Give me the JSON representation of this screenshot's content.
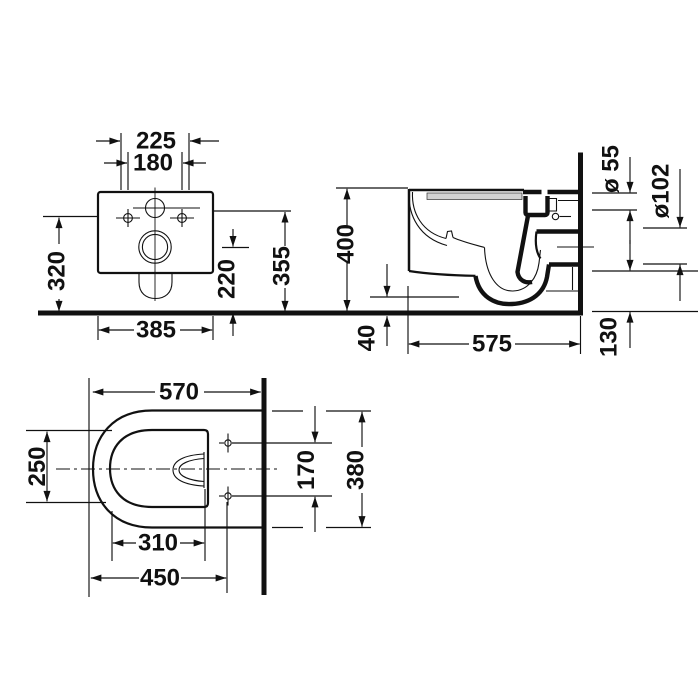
{
  "drawing": {
    "type": "technical-orthographic-drawing",
    "subject": "wall-hung toilet",
    "colors": {
      "line": "#111111",
      "seat_band": "#d2d2d2",
      "background": "#ffffff"
    },
    "views": {
      "rear": {
        "name": "rear view",
        "dims": {
          "supply_span": "225",
          "hole_span": "180",
          "height_left": "320",
          "height_right": "355",
          "outlet_height": "220",
          "width": "385"
        }
      },
      "side": {
        "name": "side section view",
        "dims": {
          "height": "400",
          "floor_gap": "40",
          "depth": "575",
          "outlet_drop": "130",
          "inlet_dia": "ø 55",
          "outlet_dia": "ø102"
        }
      },
      "top": {
        "name": "top view",
        "dims": {
          "depth": "570",
          "bowl_width": "250",
          "hole_spread": "170",
          "width": "380",
          "inner_depth": "310",
          "hole_depth": "450"
        }
      }
    }
  }
}
